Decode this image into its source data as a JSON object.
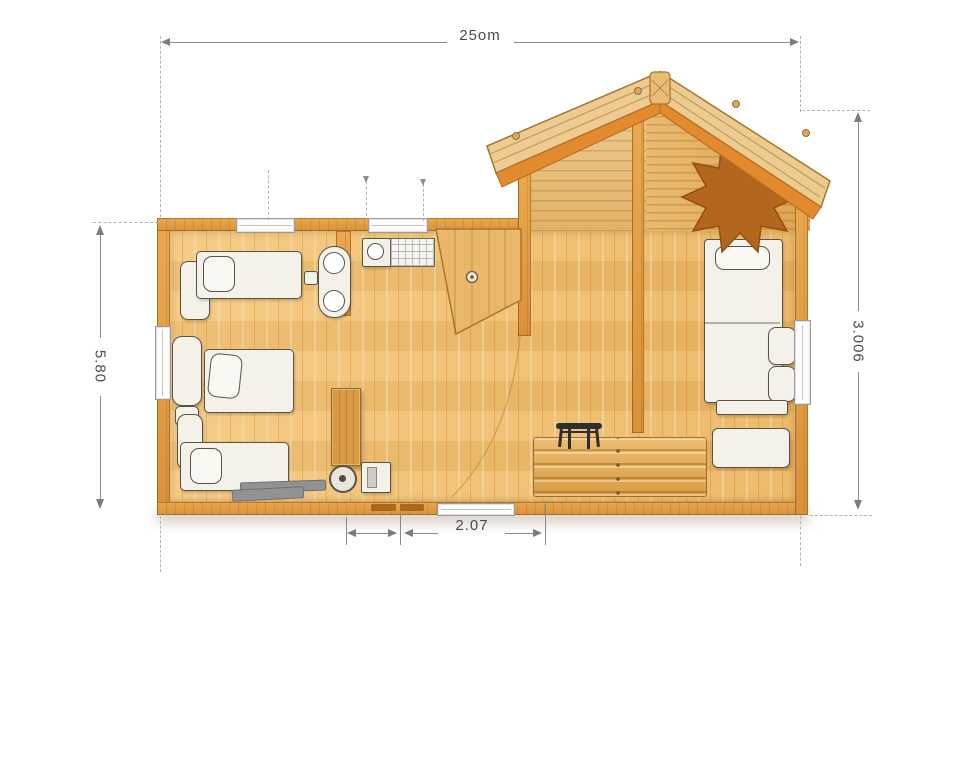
{
  "diagram": {
    "type": "floor-plan",
    "subject": "wooden cabin top view with gable roof porch"
  },
  "dimension_labels": {
    "top": "25om",
    "left": "5.80",
    "right": "3.006",
    "bottom": "2.07"
  },
  "colors": {
    "background": "#ffffff",
    "floor_wood": "#f1bf72",
    "wall_wood": "#e2a04a",
    "roof_wood": "#edcb92",
    "roof_underside": "#e18a2e",
    "furniture_fill": "#f4f1e8",
    "star_ornament": "#b2661e",
    "bench_wood": "#e2a955",
    "dimension_line": "#8a8a8a",
    "label_text": "#4a4a4a"
  },
  "icons": [
    {
      "name": "starburst-ornament-icon"
    },
    {
      "name": "single-bed"
    },
    {
      "name": "double-bed"
    },
    {
      "name": "sofa-bed"
    },
    {
      "name": "bench"
    },
    {
      "name": "coffee-table"
    },
    {
      "name": "ottoman"
    },
    {
      "name": "twin-basin-vanity"
    },
    {
      "name": "washbasin-unit"
    },
    {
      "name": "tiled-counter"
    },
    {
      "name": "tall-cabinet"
    },
    {
      "name": "floor-drain"
    },
    {
      "name": "appliance"
    },
    {
      "name": "open-door"
    },
    {
      "name": "window"
    },
    {
      "name": "doorway"
    }
  ]
}
